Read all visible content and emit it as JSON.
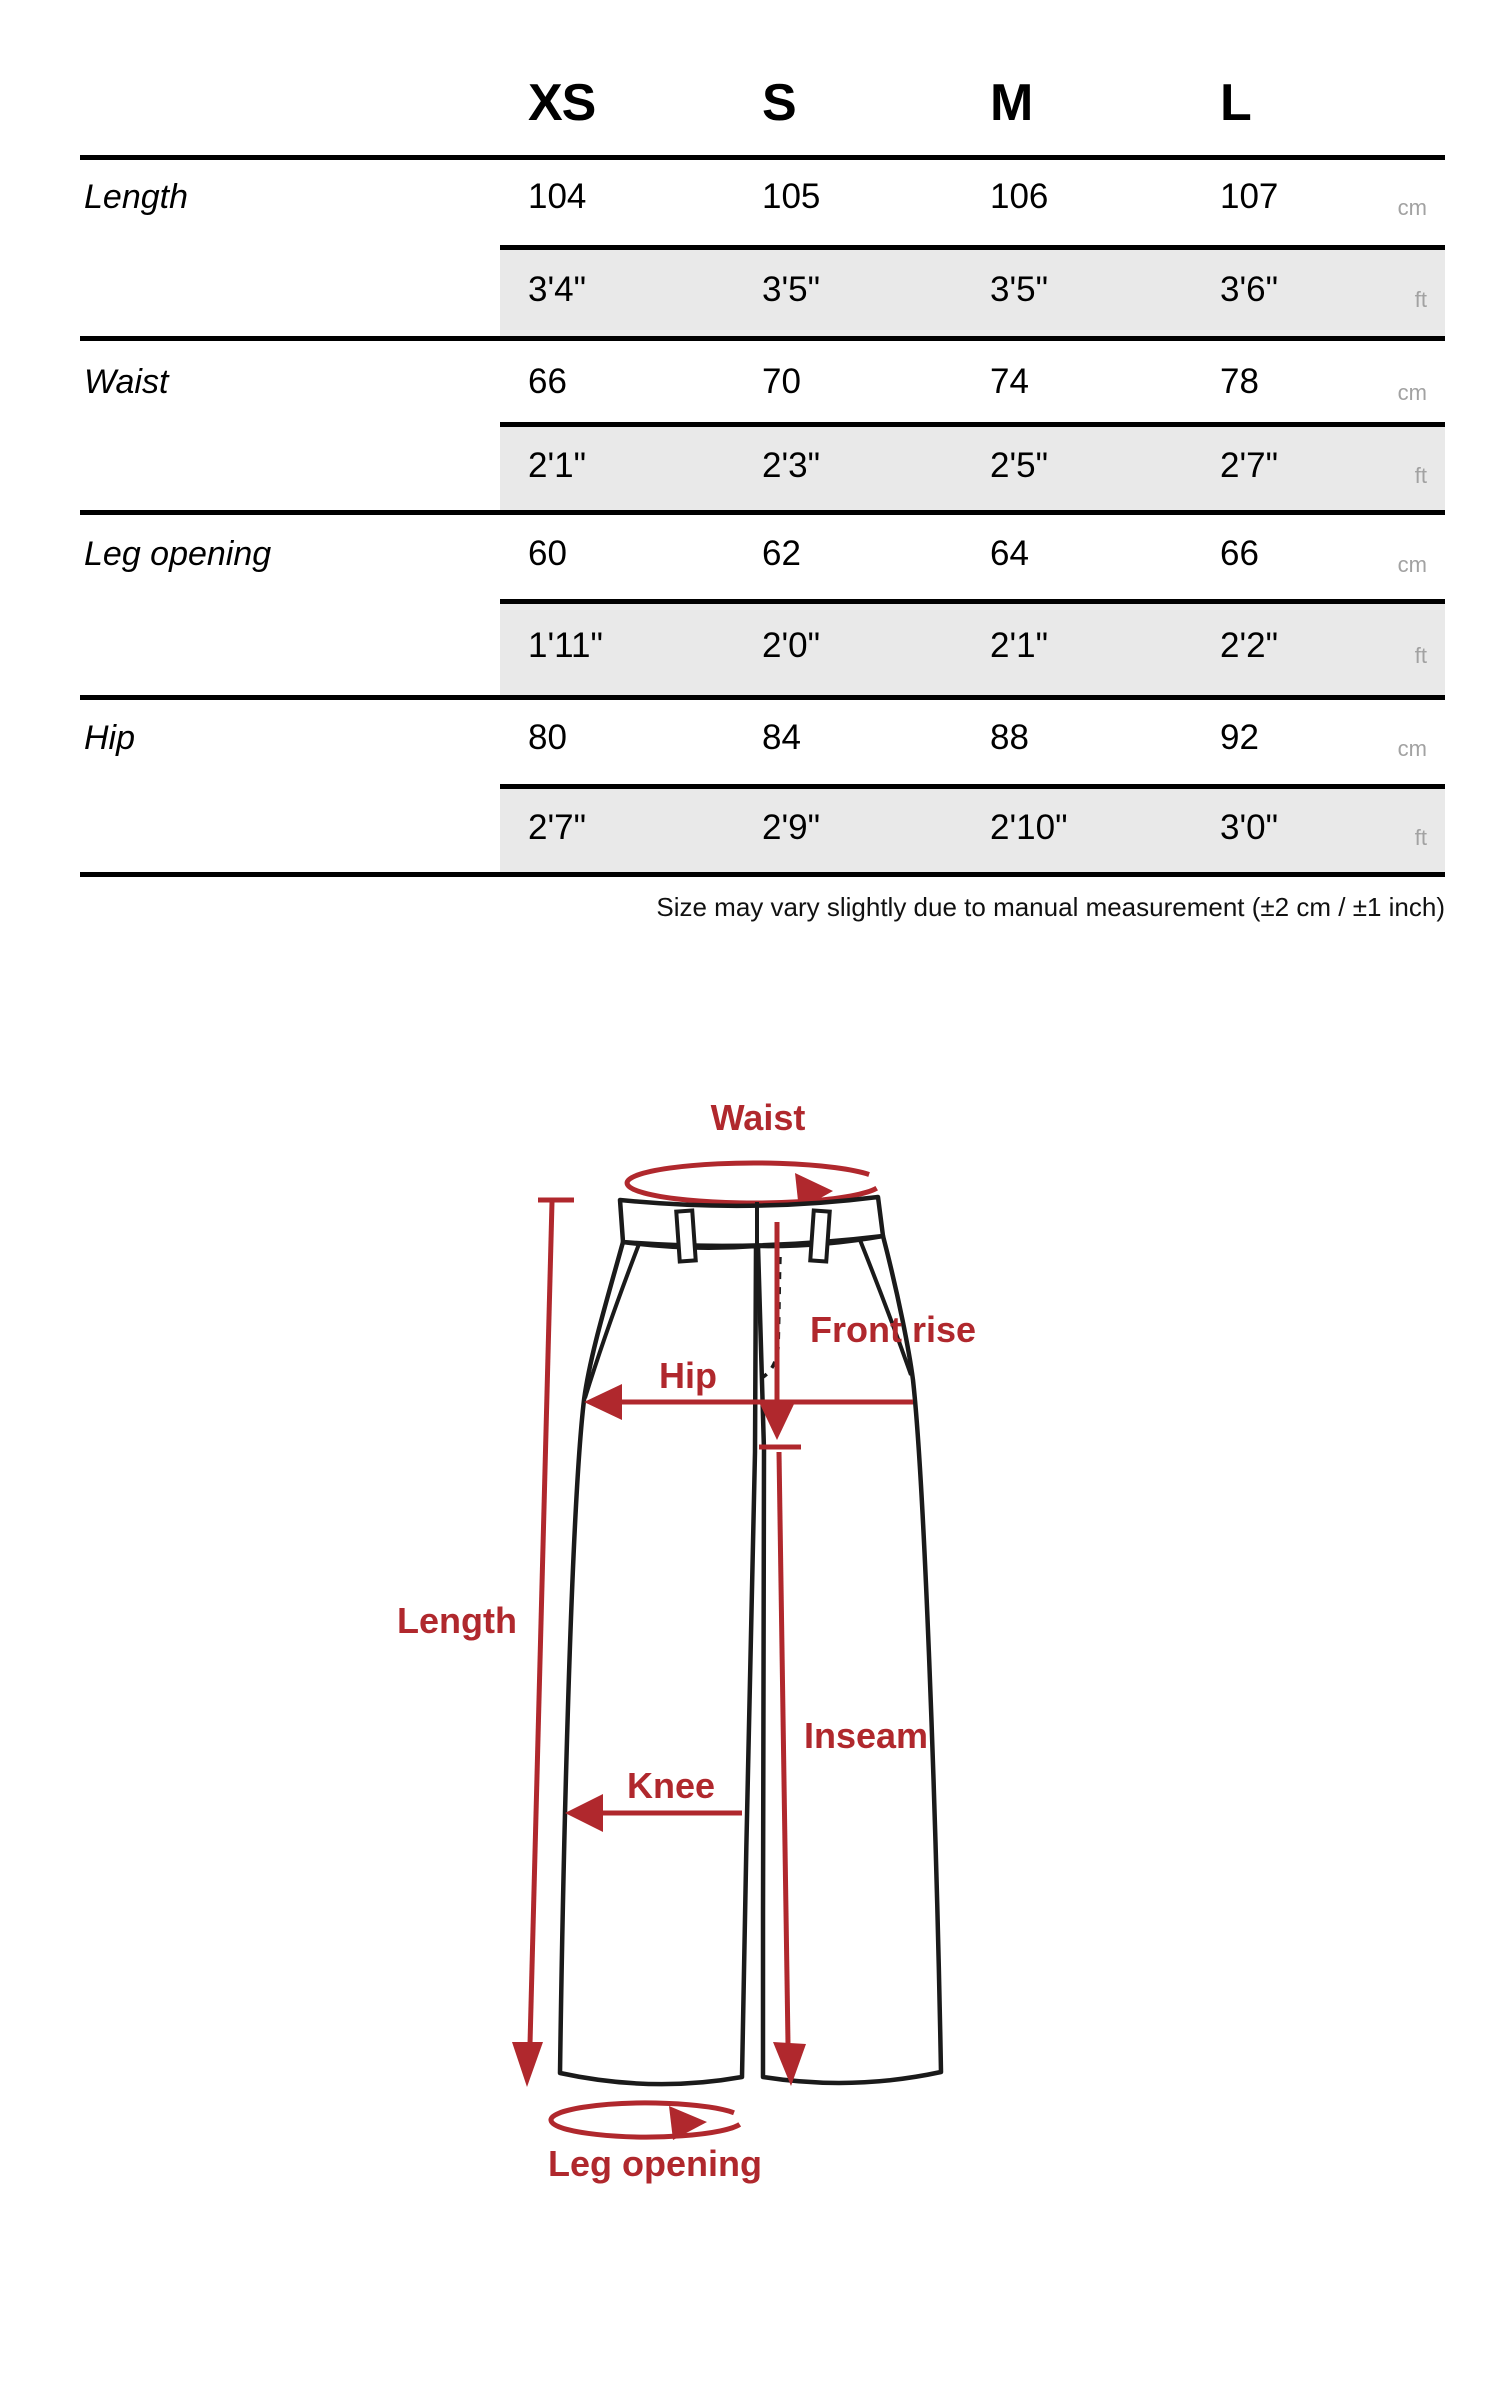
{
  "table": {
    "sizes": [
      "XS",
      "S",
      "M",
      "L"
    ],
    "unit_cm": "cm",
    "unit_ft": "ft",
    "rows": [
      {
        "label": "Length",
        "cm": [
          "104",
          "105",
          "106",
          "107"
        ],
        "ft": [
          "3'4\"",
          "3'5\"",
          "3'5\"",
          "3'6\""
        ]
      },
      {
        "label": "Waist",
        "cm": [
          "66",
          "70",
          "74",
          "78"
        ],
        "ft": [
          "2'1\"",
          "2'3\"",
          "2'5\"",
          "2'7\""
        ]
      },
      {
        "label": "Leg opening",
        "cm": [
          "60",
          "62",
          "64",
          "66"
        ],
        "ft": [
          "1'11\"",
          "2'0\"",
          "2'1\"",
          "2'2\""
        ]
      },
      {
        "label": "Hip",
        "cm": [
          "80",
          "84",
          "88",
          "92"
        ],
        "ft": [
          "2'7\"",
          "2'9\"",
          "2'10\"",
          "3'0\""
        ]
      }
    ],
    "note": "Size may vary slightly due to manual measurement (±2 cm / ±1 inch)"
  },
  "diagram": {
    "labels": {
      "waist": "Waist",
      "front_rise": "Front rise",
      "hip": "Hip",
      "length": "Length",
      "inseam": "Inseam",
      "knee": "Knee",
      "leg_opening": "Leg opening"
    },
    "colors": {
      "annotation_red": "#b0282d",
      "outline_black": "#1a1a1a"
    }
  },
  "colors": {
    "band_gray": "#e9e9e9",
    "unit_gray": "#a2a2a2",
    "rule_black": "#000000"
  }
}
